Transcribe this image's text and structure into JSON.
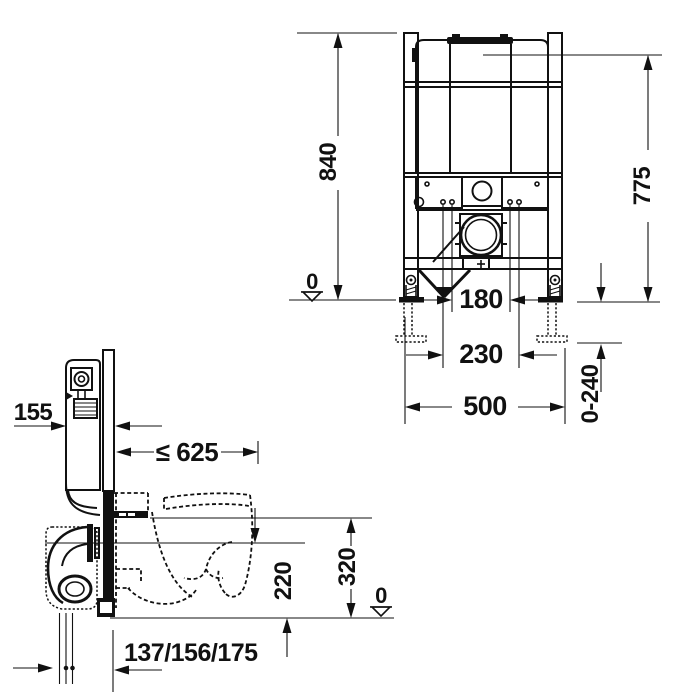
{
  "drawing": {
    "background_color": "#ffffff",
    "line_color": "#111111",
    "front_view": {
      "overall_height": "840",
      "actuator_height": "775",
      "floor_datum": "0",
      "bolt_spacing": "180",
      "fixing_spacing": "230",
      "frame_width": "500",
      "foot_adjustment_range": "0-240"
    },
    "side_view": {
      "frame_depth": "155",
      "max_projection": "≤ 625",
      "outlet_height": "220",
      "connection_height": "320",
      "floor_datum": "0",
      "pipe_offsets": "137/156/175"
    }
  }
}
